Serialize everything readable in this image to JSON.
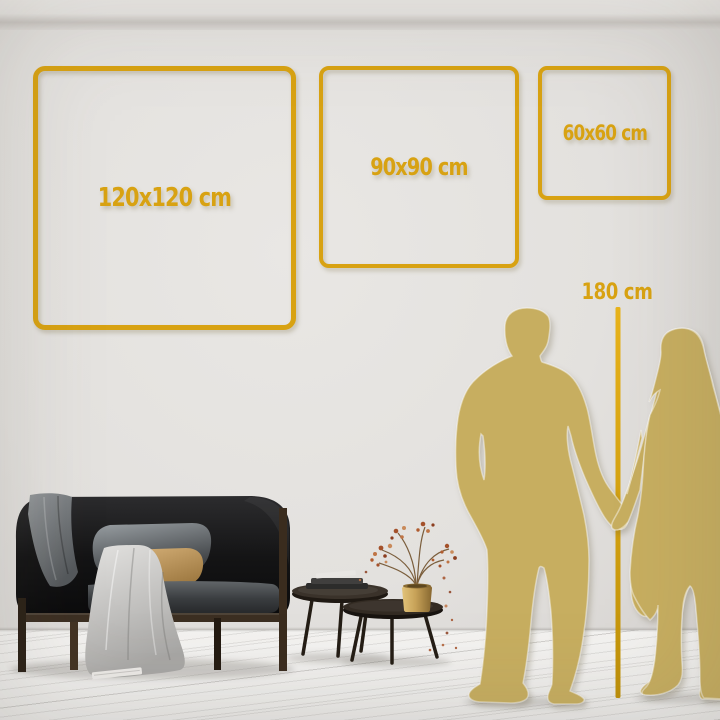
{
  "scene": {
    "description": "Metal wall art size comparison in living room",
    "frames": [
      {
        "id": "120",
        "label": "120x120 cm",
        "width_cm": 120,
        "height_cm": 120
      },
      {
        "id": "90",
        "label": "90x90 cm",
        "width_cm": 90,
        "height_cm": 90
      },
      {
        "id": "60",
        "label": "60x60 cm",
        "width_cm": 60,
        "height_cm": 60
      }
    ],
    "ruler": {
      "label": "180 cm",
      "height_cm": 180
    },
    "colors": {
      "accent_gold": "#d8a212",
      "silhouette_gold": "#c7ae60",
      "wall": "#e4e2df",
      "floor": "#f1f0ee"
    }
  }
}
